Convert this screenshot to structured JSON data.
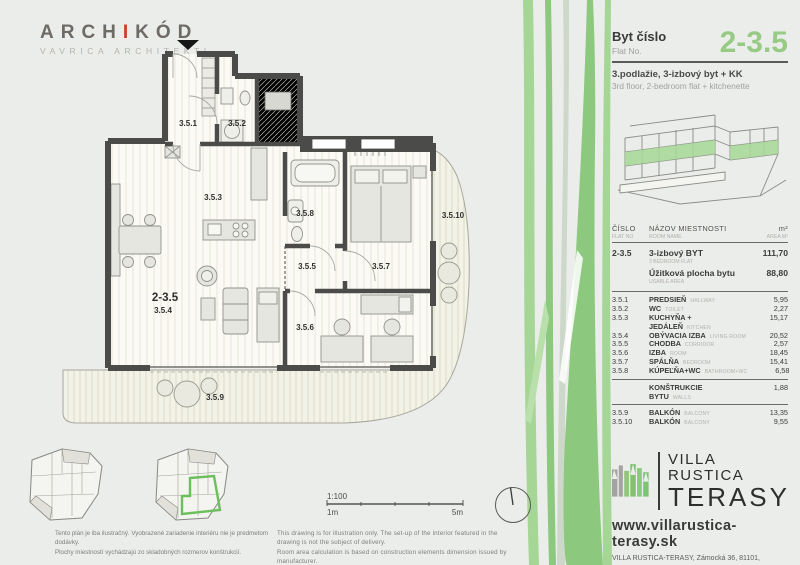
{
  "logo": {
    "part1": "ARCH",
    "accent": "I",
    "part2": "KÓD",
    "subtitle": "VAVRICA ARCHITEKTI"
  },
  "header": {
    "title_sk": "Byt číslo",
    "title_en": "Flat No.",
    "flat_no": "2-3.5",
    "desc_sk": "3.podlažie, 3-izbový byt + KK",
    "desc_en": "3rd floor, 2-bedroom flat + kitchenette"
  },
  "plan": {
    "flat_label": "2-3.5",
    "labels": {
      "hall": "3.5.1",
      "wc": "3.5.2",
      "kitchen": "3.5.3",
      "living": "3.5.4",
      "corridor": "3.5.5",
      "room": "3.5.6",
      "bedroom": "3.5.7",
      "bathroom": "3.5.8",
      "balcony1": "3.5.9",
      "balcony2": "3.5.10"
    }
  },
  "table": {
    "headers": {
      "col1": "ČÍSLO",
      "col1_sub": "FLAT NO",
      "col2": "NÁZOV MIESTNOSTI",
      "col2_sub": "ROOM NAME",
      "col3": "m²",
      "col3_sub": "AREA M²"
    },
    "summary": {
      "no": "2-3.5",
      "name": "3-izbový BYT",
      "name_en": "3 BEDROOM FLAT",
      "area": "111,70",
      "usable": "Úžitková plocha bytu",
      "usable_en": "USABLE AREA",
      "usable_area": "88,80"
    },
    "rows": [
      {
        "no": "3.5.1",
        "name": "PREDSIEŇ",
        "name_en": "HALLWAY",
        "area": "5,95"
      },
      {
        "no": "3.5.2",
        "name": "WC",
        "name_en": "TOILET",
        "area": "2,27"
      },
      {
        "no": "3.5.3",
        "name": "KUCHYŇA + JEDÁLEŇ",
        "name_en": "KITCHEN",
        "area": "15,17"
      },
      {
        "no": "3.5.4",
        "name": "OBÝVACIA IZBA",
        "name_en": "LIVING ROOM",
        "area": "20,52"
      },
      {
        "no": "3.5.5",
        "name": "CHODBA",
        "name_en": "CORRIDOR",
        "area": "2,57"
      },
      {
        "no": "3.5.6",
        "name": "IZBA",
        "name_en": "ROOM",
        "area": "18,45"
      },
      {
        "no": "3.5.7",
        "name": "SPÁLŇA",
        "name_en": "BEDROOM",
        "area": "15,41"
      },
      {
        "no": "3.5.8",
        "name": "KÚPEĽŇA+WC",
        "name_en": "BATHROOM+WC",
        "area": "6,58"
      }
    ],
    "walls": {
      "name": "KONŠTRUKCIE BYTU",
      "name_en": "WALLS",
      "area": "1,88"
    },
    "balconies": [
      {
        "no": "3.5.9",
        "name": "BALKÓN",
        "name_en": "BALCONY",
        "area": "13,35"
      },
      {
        "no": "3.5.10",
        "name": "BALKÓN",
        "name_en": "BALCONY",
        "area": "9,55"
      }
    ]
  },
  "scale": {
    "ratio": "1:100",
    "start": "1m",
    "end": "5m"
  },
  "disclaimers": {
    "sk1": "Tento plán je iba ilustračný. Vyobrazené zariadenie interiéru nie je predmetom dodávky.",
    "sk2": "Plochy miestností vychádzajú zo skladobných rozmerov konštrukcií.",
    "en1": "This drawing is for illustration only. The set-up of the interior featured in the drawing is not the subject of delivery.",
    "en2": "Room area calculation is based on construction elements dimension issued by manufacturer."
  },
  "brand": {
    "name1": "VILLA RUSTICA",
    "name2": "TERASY",
    "website": "www.villarustica-terasy.sk",
    "address": "VILLA RUSTICA-TERASY, Zámocká 36, 81101, Bratislava",
    "contact": "tel.: +421-2-546 303 61, mail: info@villarustica.sk"
  },
  "colors": {
    "accent_green": "#8cc87d",
    "wall": "#4b4b49",
    "logo_red": "#d03a2a"
  }
}
